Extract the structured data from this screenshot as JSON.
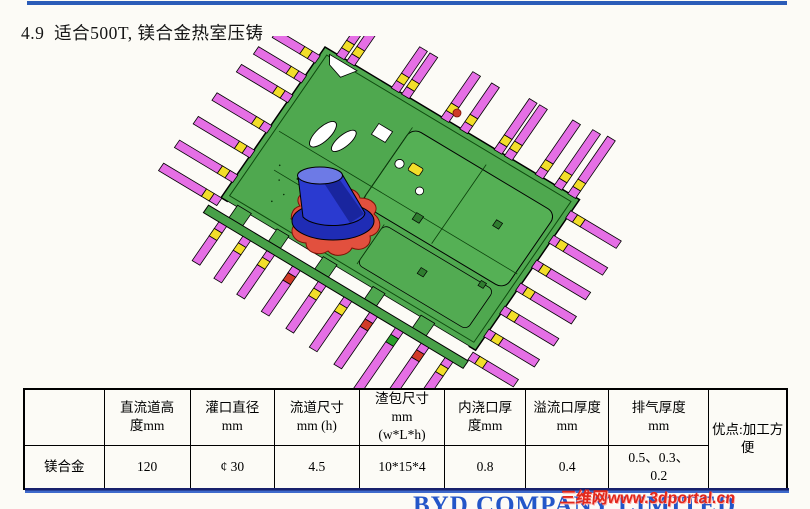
{
  "title": "4.9  适合500T, 镁合金热室压铸",
  "table": {
    "headers": [
      "",
      "直流道高\n度mm",
      "灌口直径\nmm",
      "流道尺寸\nmm (h)",
      "渣包尺寸\nmm\n(w*L*h)",
      "内浇口厚\n度mm",
      "溢流口厚度\nmm",
      "排气厚度\nmm",
      "优点:加工方\n便"
    ],
    "rows": [
      {
        "label": "镁合金",
        "values": [
          "120",
          "¢ 30",
          "4.5",
          "10*15*4",
          "0.8",
          "0.4",
          "0.5、0.3、\n0.2"
        ]
      }
    ]
  },
  "footer": {
    "company": "BYD COMPANY LIMITED",
    "watermark": "三维网www.3dportal.cn"
  },
  "colors": {
    "top_bar": "#2b5cb8",
    "rule_dark": "#17206b",
    "rule_blue": "#3f6acc",
    "company_text": "#2356c9",
    "watermark_red": "#e2281c",
    "plate_green": "#4fa84f",
    "panel_green": "#55b055",
    "rail_green": "#48a048",
    "runner_pink": "#e56fe5",
    "vent_yellow": "#f2de2a",
    "sprue_blue": "#2a3ad0",
    "sprue_top_blue": "#6d7ae6",
    "flange_blue": "#1f2cb5",
    "biscuit_red": "#e2503e",
    "accent_red": "#d23b28",
    "accent_green": "#2ca02c"
  }
}
